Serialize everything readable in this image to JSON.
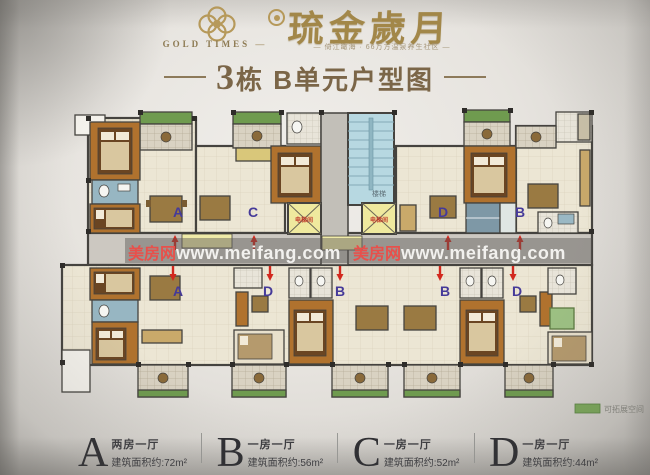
{
  "header": {
    "brand_en": "GOLD TIMES",
    "brand_cn": "琉金歲月",
    "tagline": "倚江瞰海 · 66万方温泉养生社区",
    "title": "3栋 B单元户型图"
  },
  "watermark": {
    "site_name": "美房网",
    "site_url": "www.meifang.com",
    "instances": [
      {
        "x": 128,
        "y": 259
      },
      {
        "x": 353,
        "y": 259
      }
    ],
    "name_color": "#e8504b",
    "url_color": "#f2f1ee"
  },
  "plan": {
    "stair_label": "楼梯",
    "elevator_label": "电梯间",
    "expandable_label": "可拓展空间",
    "label_color": "#453a99",
    "arrow_color": "#d2281e",
    "expandable_color": "#7ba85a",
    "unit_labels": [
      {
        "letter": "A",
        "x": 178,
        "y": 217
      },
      {
        "letter": "C",
        "x": 253,
        "y": 217
      },
      {
        "letter": "D",
        "x": 443,
        "y": 217
      },
      {
        "letter": "B",
        "x": 520,
        "y": 217
      },
      {
        "letter": "A",
        "x": 178,
        "y": 296
      },
      {
        "letter": "D",
        "x": 268,
        "y": 296
      },
      {
        "letter": "B",
        "x": 340,
        "y": 296
      },
      {
        "letter": "B",
        "x": 445,
        "y": 296
      },
      {
        "letter": "D",
        "x": 517,
        "y": 296
      }
    ],
    "entry_arrows": [
      {
        "x": 175,
        "y": 243,
        "dir": "up"
      },
      {
        "x": 254,
        "y": 243,
        "dir": "up"
      },
      {
        "x": 448,
        "y": 243,
        "dir": "up"
      },
      {
        "x": 520,
        "y": 243,
        "dir": "up"
      },
      {
        "x": 173,
        "y": 273,
        "dir": "down"
      },
      {
        "x": 270,
        "y": 273,
        "dir": "down"
      },
      {
        "x": 340,
        "y": 273,
        "dir": "down"
      },
      {
        "x": 440,
        "y": 273,
        "dir": "down"
      },
      {
        "x": 513,
        "y": 273,
        "dir": "down"
      }
    ]
  },
  "legend": {
    "items": [
      {
        "letter": "A",
        "layout": "两房一厅",
        "area": "建筑面积约:72m²"
      },
      {
        "letter": "B",
        "layout": "一房一厅",
        "area": "建筑面积约:56m²"
      },
      {
        "letter": "C",
        "layout": "一房一厅",
        "area": "建筑面积约:52m²"
      },
      {
        "letter": "D",
        "layout": "一房一厅",
        "area": "建筑面积约:44m²"
      }
    ]
  }
}
